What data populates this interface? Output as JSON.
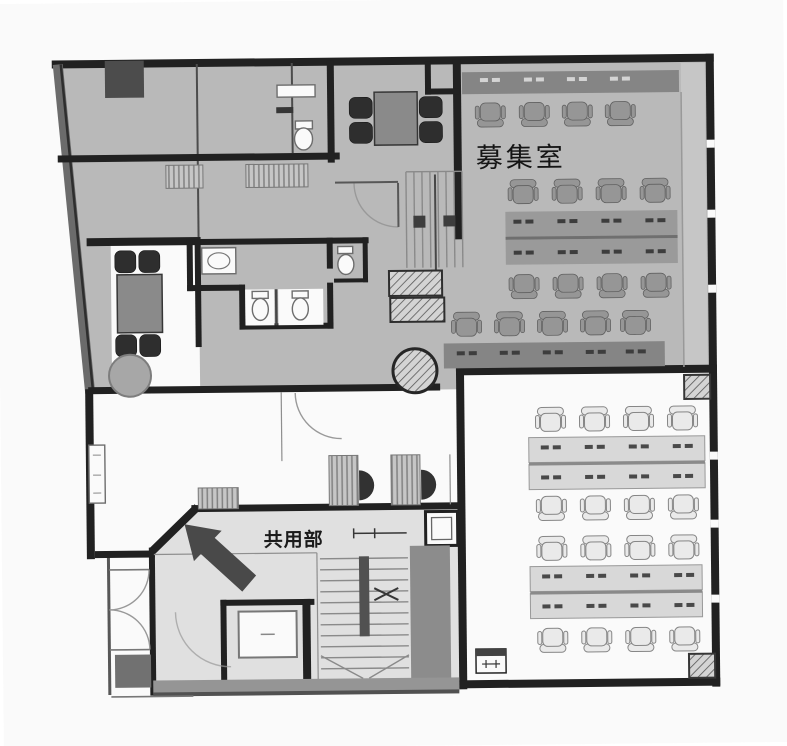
{
  "floorplan": {
    "kind": "scanned-office-floor-plan",
    "labels": {
      "office_room": "募集室",
      "common_area": "共用部"
    },
    "rooms": [
      {
        "name": "募集室",
        "floor_shade": "gray",
        "furniture": "desk clusters with office chairs"
      },
      {
        "name": "共用部",
        "floor_shade": "light-gray",
        "furniture": "staircase, elevator, entrance arrow"
      }
    ],
    "colors": {
      "wall": "#1d1d1d",
      "leased_floor": "#bcbcbc",
      "common_floor": "#e4e4e4",
      "desk_band_dark": "#858585",
      "desk_band_mid": "#9b9b9b",
      "furniture_dark": "#474747",
      "paper": "#ffffff"
    }
  }
}
